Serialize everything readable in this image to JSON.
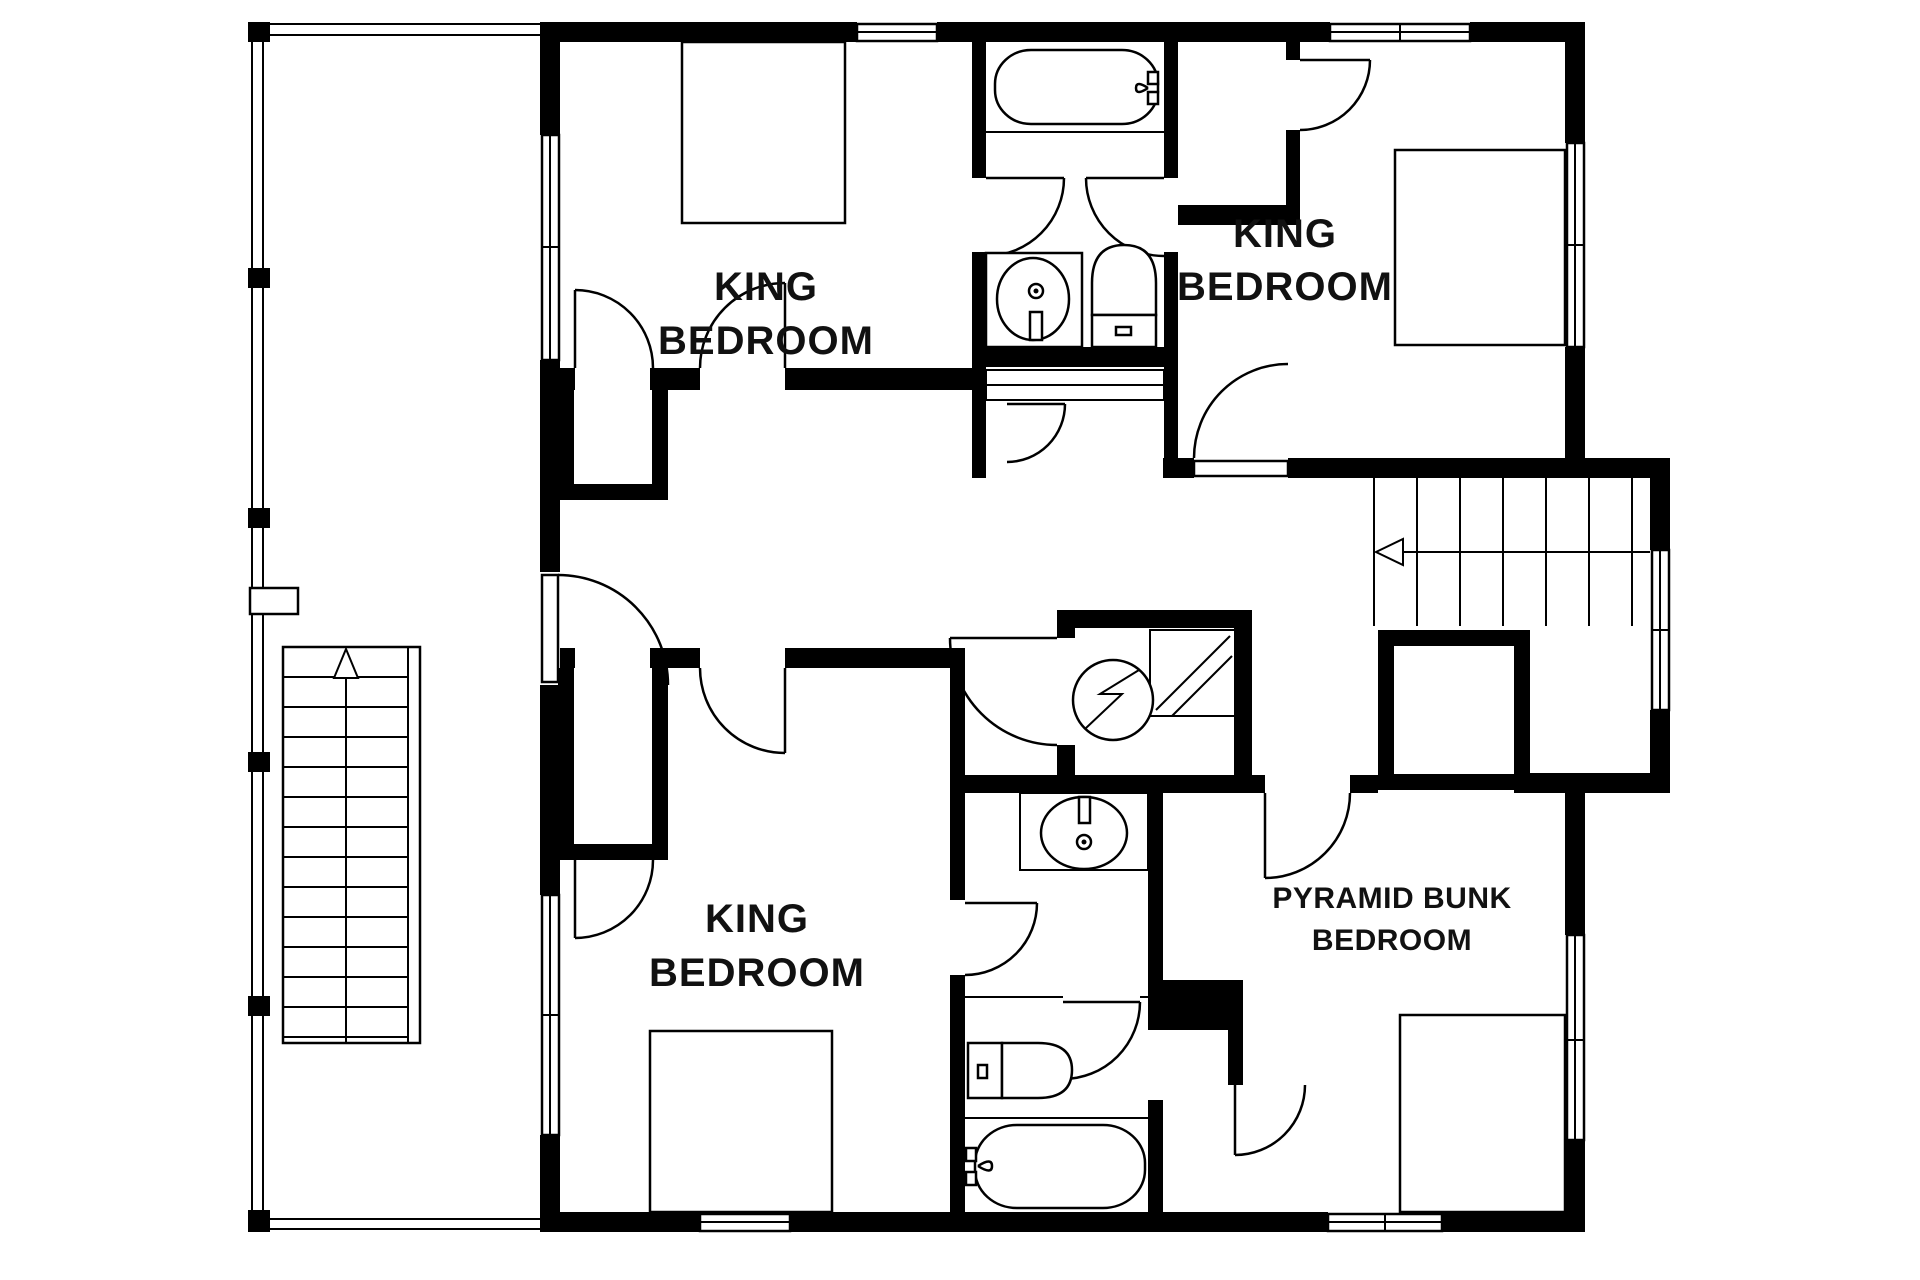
{
  "title": "Second floor plan",
  "colors": {
    "wall": "#000000",
    "background": "#ffffff",
    "line": "#000000",
    "text": "#111111"
  },
  "rooms": {
    "king_top_left": {
      "line1": "KING",
      "line2": "BEDROOM"
    },
    "king_top_right": {
      "line1": "KING",
      "line2": "BEDROOM"
    },
    "king_bottom_left": {
      "line1": "KING",
      "line2": "BEDROOM"
    },
    "pyramid_bunk": {
      "line1": "PYRAMID BUNK",
      "line2": "BEDROOM"
    }
  },
  "fixtures": {
    "bathroom_top": [
      "bathtub-icon",
      "sink-icon",
      "toilet-icon",
      "linen-closet-icon"
    ],
    "bathroom_bottom": [
      "vanity-sink-icon",
      "toilet-icon",
      "bathtub-icon"
    ],
    "hall": [
      "shower-icon",
      "stairs-icon"
    ],
    "deck": [
      "stairs-icon",
      "gate-icon"
    ],
    "bedrooms": [
      "bed-icon",
      "bed-icon",
      "bed-icon",
      "bed-icon"
    ]
  },
  "stairs": {
    "interior": {
      "direction_arrow": "left"
    },
    "deck": {
      "direction_arrow": "up"
    }
  }
}
